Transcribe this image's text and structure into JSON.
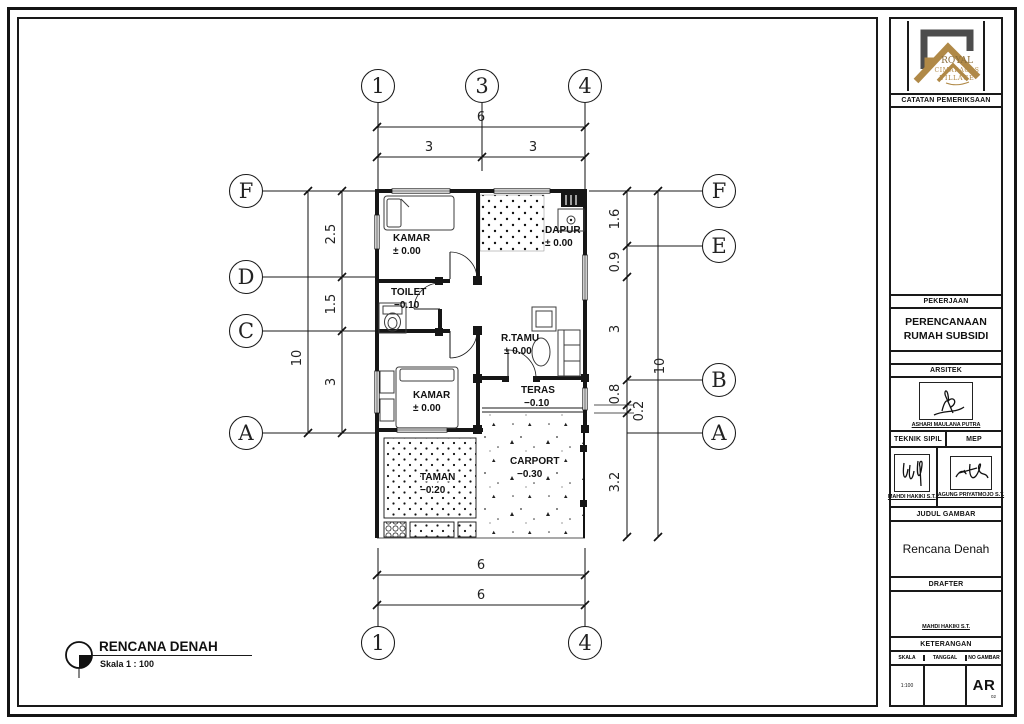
{
  "drawing_title": {
    "title": "RENCANA DENAH",
    "scale": "Skala 1 : 100"
  },
  "plan": {
    "grid_top": [
      "1",
      "3",
      "4"
    ],
    "grid_bottom": [
      "1",
      "4"
    ],
    "grid_left": [
      "F",
      "D",
      "C",
      "A"
    ],
    "grid_right": [
      "F",
      "E",
      "B",
      "A"
    ],
    "dims_top": {
      "overall": "6",
      "seg1": "3",
      "seg2": "3"
    },
    "dims_bottom": {
      "line1": "6",
      "line2": "6"
    },
    "dims_left": {
      "overall": "10",
      "seg1": "2.5",
      "seg2": "1.5",
      "seg3": "3"
    },
    "dims_right": {
      "overall": "10",
      "seg1": "1.6",
      "seg2": "0.9",
      "seg3": "3",
      "seg4": "0.8",
      "seg5": "0.2",
      "seg6": "3.2"
    },
    "rooms": {
      "kamar1": {
        "name": "KAMAR",
        "elev": "± 0.00"
      },
      "dapur": {
        "name": "DAPUR",
        "elev": "± 0.00"
      },
      "toilet": {
        "name": "TOILET",
        "elev": "−0.10"
      },
      "rtamu": {
        "name": "R.TAMU",
        "elev": "± 0.00"
      },
      "kamar2": {
        "name": "KAMAR",
        "elev": "± 0.00"
      },
      "teras": {
        "name": "TERAS",
        "elev": "−0.10"
      },
      "taman": {
        "name": "TAMAN",
        "elev": "−0.20"
      },
      "carport": {
        "name": "CARPORT",
        "elev": "−0.30"
      }
    }
  },
  "title_block": {
    "logo": {
      "line1": "ROYAL",
      "line2": "CIMARAGAS",
      "line3": "VILLAGE",
      "gold": "#b08947",
      "gray": "#4d4d4d"
    },
    "catatan_label": "CATATAN PEMERIKSAAN",
    "pekerjaan_label": "PEKERJAAN",
    "pekerjaan_value": "PERENCANAAN RUMAH SUBSIDI",
    "arsitek_label": "ARSITEK",
    "arsitek_name": "ASHARI MAULANA PUTRA",
    "teknik_sipil_label": "TEKNIK SIPIL",
    "teknik_sipil_name": "MAHDI HAKIKI S.T.",
    "mep_label": "MEP",
    "mep_name": "AGUNG PRIYATMOJO S.T.",
    "judul_label": "JUDUL GAMBAR",
    "judul_value": "Rencana Denah",
    "drafter_label": "DRAFTER",
    "drafter_name": "MAHDI HAKIKI S.T.",
    "keterangan_label": "KETERANGAN",
    "skala_label": "SKALA",
    "skala_value": "1:100",
    "tanggal_label": "TANGGAL",
    "tanggal_value": "",
    "no_gambar_label": "NO GAMBAR",
    "no_gambar_code": "AR",
    "no_gambar_num": "02"
  }
}
